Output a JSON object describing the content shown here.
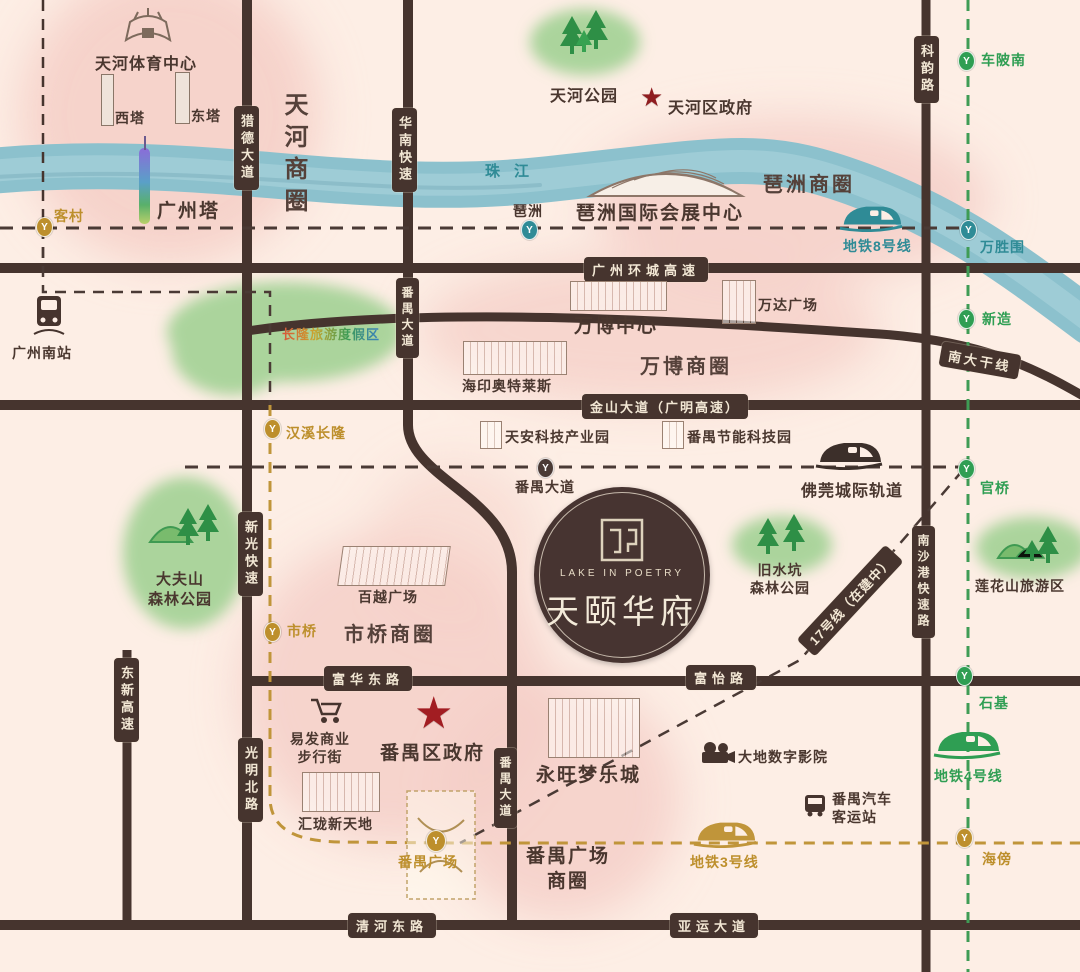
{
  "project": {
    "name_cn": "天颐华府",
    "name_en": "LAKE IN POETRY"
  },
  "river": {
    "label": "珠江"
  },
  "roads": {
    "liede": "猎德大道",
    "huanan": "华南快速",
    "keyun": "科韵路",
    "ring_expwy": "广州环城高速",
    "jinshan": "金山大道（广明高速）",
    "nanda": "南大干线",
    "panyu_mid": "番禺大道",
    "panyu_bottom": "番禺大道",
    "xinguang": "新光快速",
    "guangming": "光明北路",
    "dongxin": "东新高速",
    "fuhua": "富华东路",
    "fuyi": "富怡路",
    "nansha": "南沙港快速路",
    "qinghe": "清河东路",
    "yayun": "亚运大道"
  },
  "metro": {
    "line3": "地铁3号线",
    "line4": "地铁4号线",
    "line8": "地铁8号线",
    "intercity": "佛莞城际轨道",
    "line17": "17号线（在建中）"
  },
  "stations": {
    "kecun": "客村",
    "pazhou": "琶洲",
    "chebeinan": "车陂南",
    "wanshengwei": "万胜围",
    "xinzao": "新造",
    "hanxichanglong": "汉溪长隆",
    "panyudadao": "番禺大道",
    "guanqiao": "官桥",
    "shiqiao": "市桥",
    "shiji": "石基",
    "haibang": "海傍",
    "panyusquare": "番禺广场"
  },
  "districts": {
    "tianhe": "天河商圈",
    "pazhou": "琶洲商圈",
    "wanbo": "万博商圈",
    "shiqiao": "市桥商圈",
    "panyusquare": [
      "番禺广场",
      "商圈"
    ]
  },
  "places": {
    "tianhe_sports": "天河体育中心",
    "west_tower": "西塔",
    "east_tower": "东塔",
    "canton_tower": "广州塔",
    "tianhe_park": "天河公园",
    "tianhe_gov": "天河区政府",
    "pazhou_expo": "琶洲国际会展中心",
    "gz_south": "广州南站",
    "changlong": "长隆旅游度假区",
    "wanbo_center": "万博中心",
    "wanda": "万达广场",
    "haiyin": "海印奥特莱斯",
    "tianan": "天安科技产业园",
    "panyu_tech": "番禺节能科技园",
    "dafushan": [
      "大夫山",
      "森林公园"
    ],
    "jiushuikeng": [
      "旧水坑",
      "森林公园"
    ],
    "lianhuashan": "莲花山旅游区",
    "baiyue": "百越广场",
    "yifa": [
      "易发商业",
      "步行街"
    ],
    "panyu_gov": "番禺区政府",
    "huilong": "汇珑新天地",
    "aeon": "永旺梦乐城",
    "dadi": "大地数字影院",
    "bus_station": [
      "番禺汽车",
      "客运站"
    ]
  },
  "colors": {
    "gold": "#bd8f2c",
    "teal": "#2f8b96",
    "green": "#2f9e53",
    "road": "#46342e",
    "red_star": "#a21d22",
    "river": "#8cc1cd",
    "pink_blob": "#f5cfc8",
    "park_green": "#abd49c"
  }
}
